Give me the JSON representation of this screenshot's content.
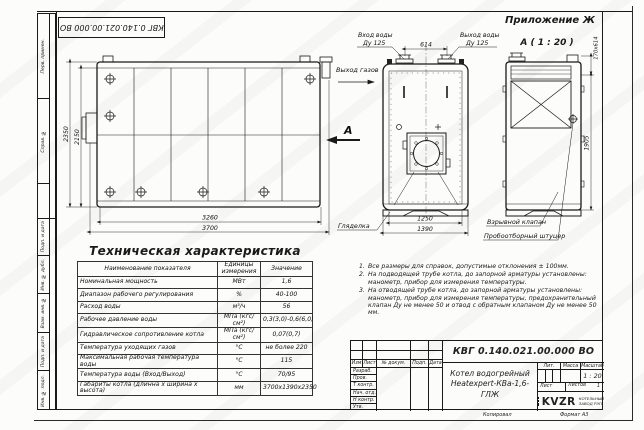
{
  "doc": {
    "stamp_top_rotated": "КВГ 0.140.021.00.000 ВО",
    "appendix_label": "Приложение Ж",
    "view_a_title": "А ( 1 : 20 )"
  },
  "margin_labels": [
    "Перв. примен.",
    "Справ. №",
    "Подп. и дата",
    "Инв. № дубл.",
    "Взам. инв. №",
    "Подп. и дата",
    "Инв. № подл."
  ],
  "drawing": {
    "gas_out_label": "Выход газов",
    "view_arrow_label": "А",
    "water_in_label": "Вход воды",
    "water_in_dn": "Ду 125",
    "water_out_label": "Выход воды",
    "water_out_dn": "Ду 125",
    "sight_glass_label": "Гляделка",
    "explosion_valve_label": "Взрывной клапан",
    "sampling_fitting_label": "Пробоотборный штуцер",
    "dim_614": "614",
    "dim_2350": "2350",
    "dim_2150": "2150",
    "dim_3260": "3260",
    "dim_3700": "3700",
    "dim_1250": "1250",
    "dim_1390": "1390",
    "dim_1905": "1905",
    "dim_170x614": "170х614"
  },
  "tech_table": {
    "title": "Техническая характеристика",
    "headers": [
      "Наименование показателя",
      "Единицы\nизмерения",
      "Значение"
    ],
    "rows": [
      [
        "Номинальная мощность",
        "МВт",
        "1,6"
      ],
      [
        "Диапазон рабочего регулирования",
        "%",
        "40-100"
      ],
      [
        "Расход воды",
        "м³/ч",
        "56"
      ],
      [
        "Рабочее давление воды",
        "МПа (кгс/см²)",
        "0,3(3,0)-0,6(6,0)"
      ],
      [
        "Гидравлическое сопротивление котла",
        "МПа (кгс/см²)",
        "0,07(0,7)"
      ],
      [
        "Температура уходящих газов",
        "°С",
        "не более 220"
      ],
      [
        "Максимальная рабочая температура воды",
        "°С",
        "115"
      ],
      [
        "Температура воды (Вход/Выход)",
        "°С",
        "70/95"
      ],
      [
        "Габариты котла (длинна х ширина х высота)",
        "мм",
        "3700х1390х2350"
      ]
    ]
  },
  "notes": {
    "items": [
      {
        "n": "1.",
        "text": "Все размеры для справок, допустимые отклонения ± 100мм."
      },
      {
        "n": "2.",
        "text": "На подводящей трубе котла, до запорной арматуры установлены: манометр, прибор для измерения температуры."
      },
      {
        "n": "3.",
        "text": "На отводящей трубе котла, до запорной арматуры установлены: манометр, прибор для измерения температуры, предохранительный клапан Ду не менее 50 и отвод с обратным клапаном Ду не менее 50 мм."
      }
    ]
  },
  "title_block": {
    "doc_number": "КВГ 0.140.021.00.000 ВО",
    "name_line1": "Котел водогрейный",
    "name_line2": "Heatexpert-КВа-1,6-ГЛЖ",
    "col_headers": [
      "Изм",
      "Лист",
      "№ докум.",
      "Подп.",
      "Дата"
    ],
    "row_labels": [
      "Разраб.",
      "Пров.",
      "Т контр.",
      "Нач. отд.",
      "Н контр.",
      "Утв."
    ],
    "lit_label": "Лит.",
    "mass_label": "Масса",
    "scale_label": "Масштаб",
    "scale_value": "1 : 20",
    "sheet_label": "Лист",
    "sheets_label": "Листов",
    "sheets_value": "1",
    "logo_text": "KVZR",
    "company_line1": "КОТЕЛЬНЫЙ",
    "company_line2": "ЗАВОД РЭП",
    "copied_label": "Копировал",
    "format_label": "Формат А3"
  }
}
